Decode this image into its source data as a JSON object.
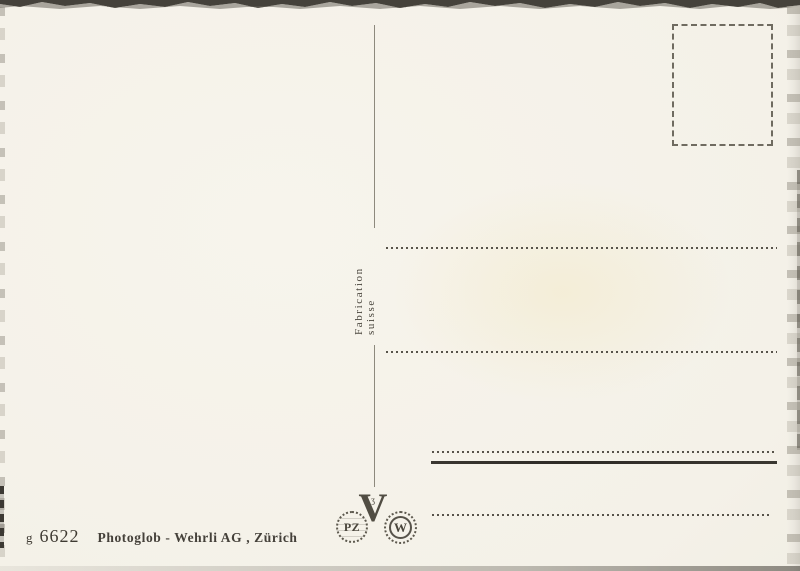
{
  "postcard": {
    "divider_label": "Fabrication suisse",
    "imprint": {
      "series": "g",
      "number": "6622",
      "publisher": "Photoglob - Wehrli AG , Zürich"
    },
    "logos": {
      "pz_monogram": "PZ",
      "v_monogram": "V",
      "w_monogram": "W"
    },
    "colors": {
      "paper": "#f4f1e8",
      "ink": "#3f3b33",
      "line_dots": "#57534a",
      "divider_line": "#8d897d"
    }
  }
}
